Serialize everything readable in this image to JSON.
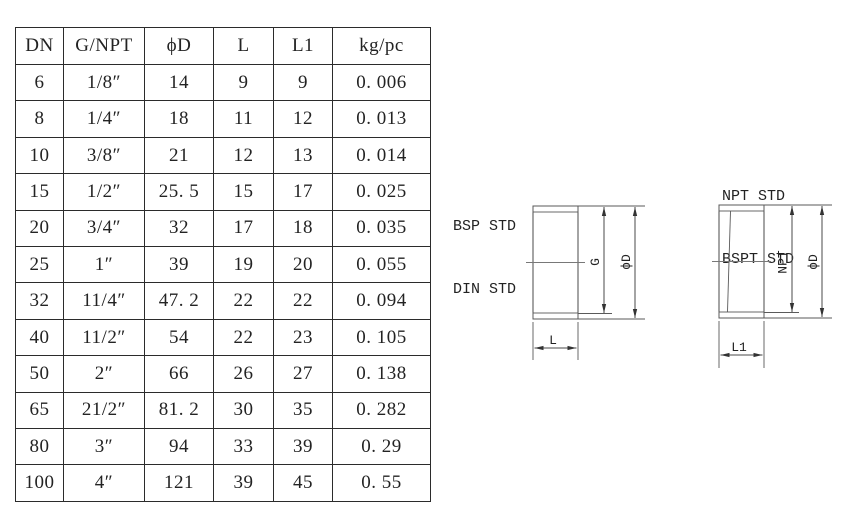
{
  "page": {
    "background": "#ffffff"
  },
  "colors": {
    "ink": "#232323",
    "table_border": "#2b2b2b",
    "drawing_line": "#4a4a4a"
  },
  "table": {
    "columns": [
      "DN",
      "G/NPT",
      "ϕD",
      "L",
      "L1",
      "kg/pc"
    ],
    "rows": [
      [
        "6",
        "1/8″",
        "14",
        "9",
        "9",
        "0. 006"
      ],
      [
        "8",
        "1/4″",
        "18",
        "11",
        "12",
        "0. 013"
      ],
      [
        "10",
        "3/8″",
        "21",
        "12",
        "13",
        "0. 014"
      ],
      [
        "15",
        "1/2″",
        "25. 5",
        "15",
        "17",
        "0. 025"
      ],
      [
        "20",
        "3/4″",
        "32",
        "17",
        "18",
        "0. 035"
      ],
      [
        "25",
        "1″",
        "39",
        "19",
        "20",
        "0. 055"
      ],
      [
        "32",
        "11/4″",
        "47. 2",
        "22",
        "22",
        "0. 094"
      ],
      [
        "40",
        "11/2″",
        "54",
        "22",
        "23",
        "0. 105"
      ],
      [
        "50",
        "2″",
        "66",
        "26",
        "27",
        "0. 138"
      ],
      [
        "65",
        "21/2″",
        "81. 2",
        "30",
        "35",
        "0. 282"
      ],
      [
        "80",
        "3″",
        "94",
        "33",
        "39",
        "0. 29"
      ],
      [
        "100",
        "4″",
        "121",
        "39",
        "45",
        "0. 55"
      ]
    ]
  },
  "drawings": {
    "left": {
      "title_line1": "BSP STD",
      "title_line2": "DIN STD",
      "dim_thread": "G",
      "dim_outer": "ϕD",
      "dim_length": "L"
    },
    "right": {
      "title_line1": "NPT STD",
      "title_line2": "BSPT STD",
      "dim_thread": "NPT",
      "dim_outer": "ϕD",
      "dim_length": "L1"
    }
  }
}
